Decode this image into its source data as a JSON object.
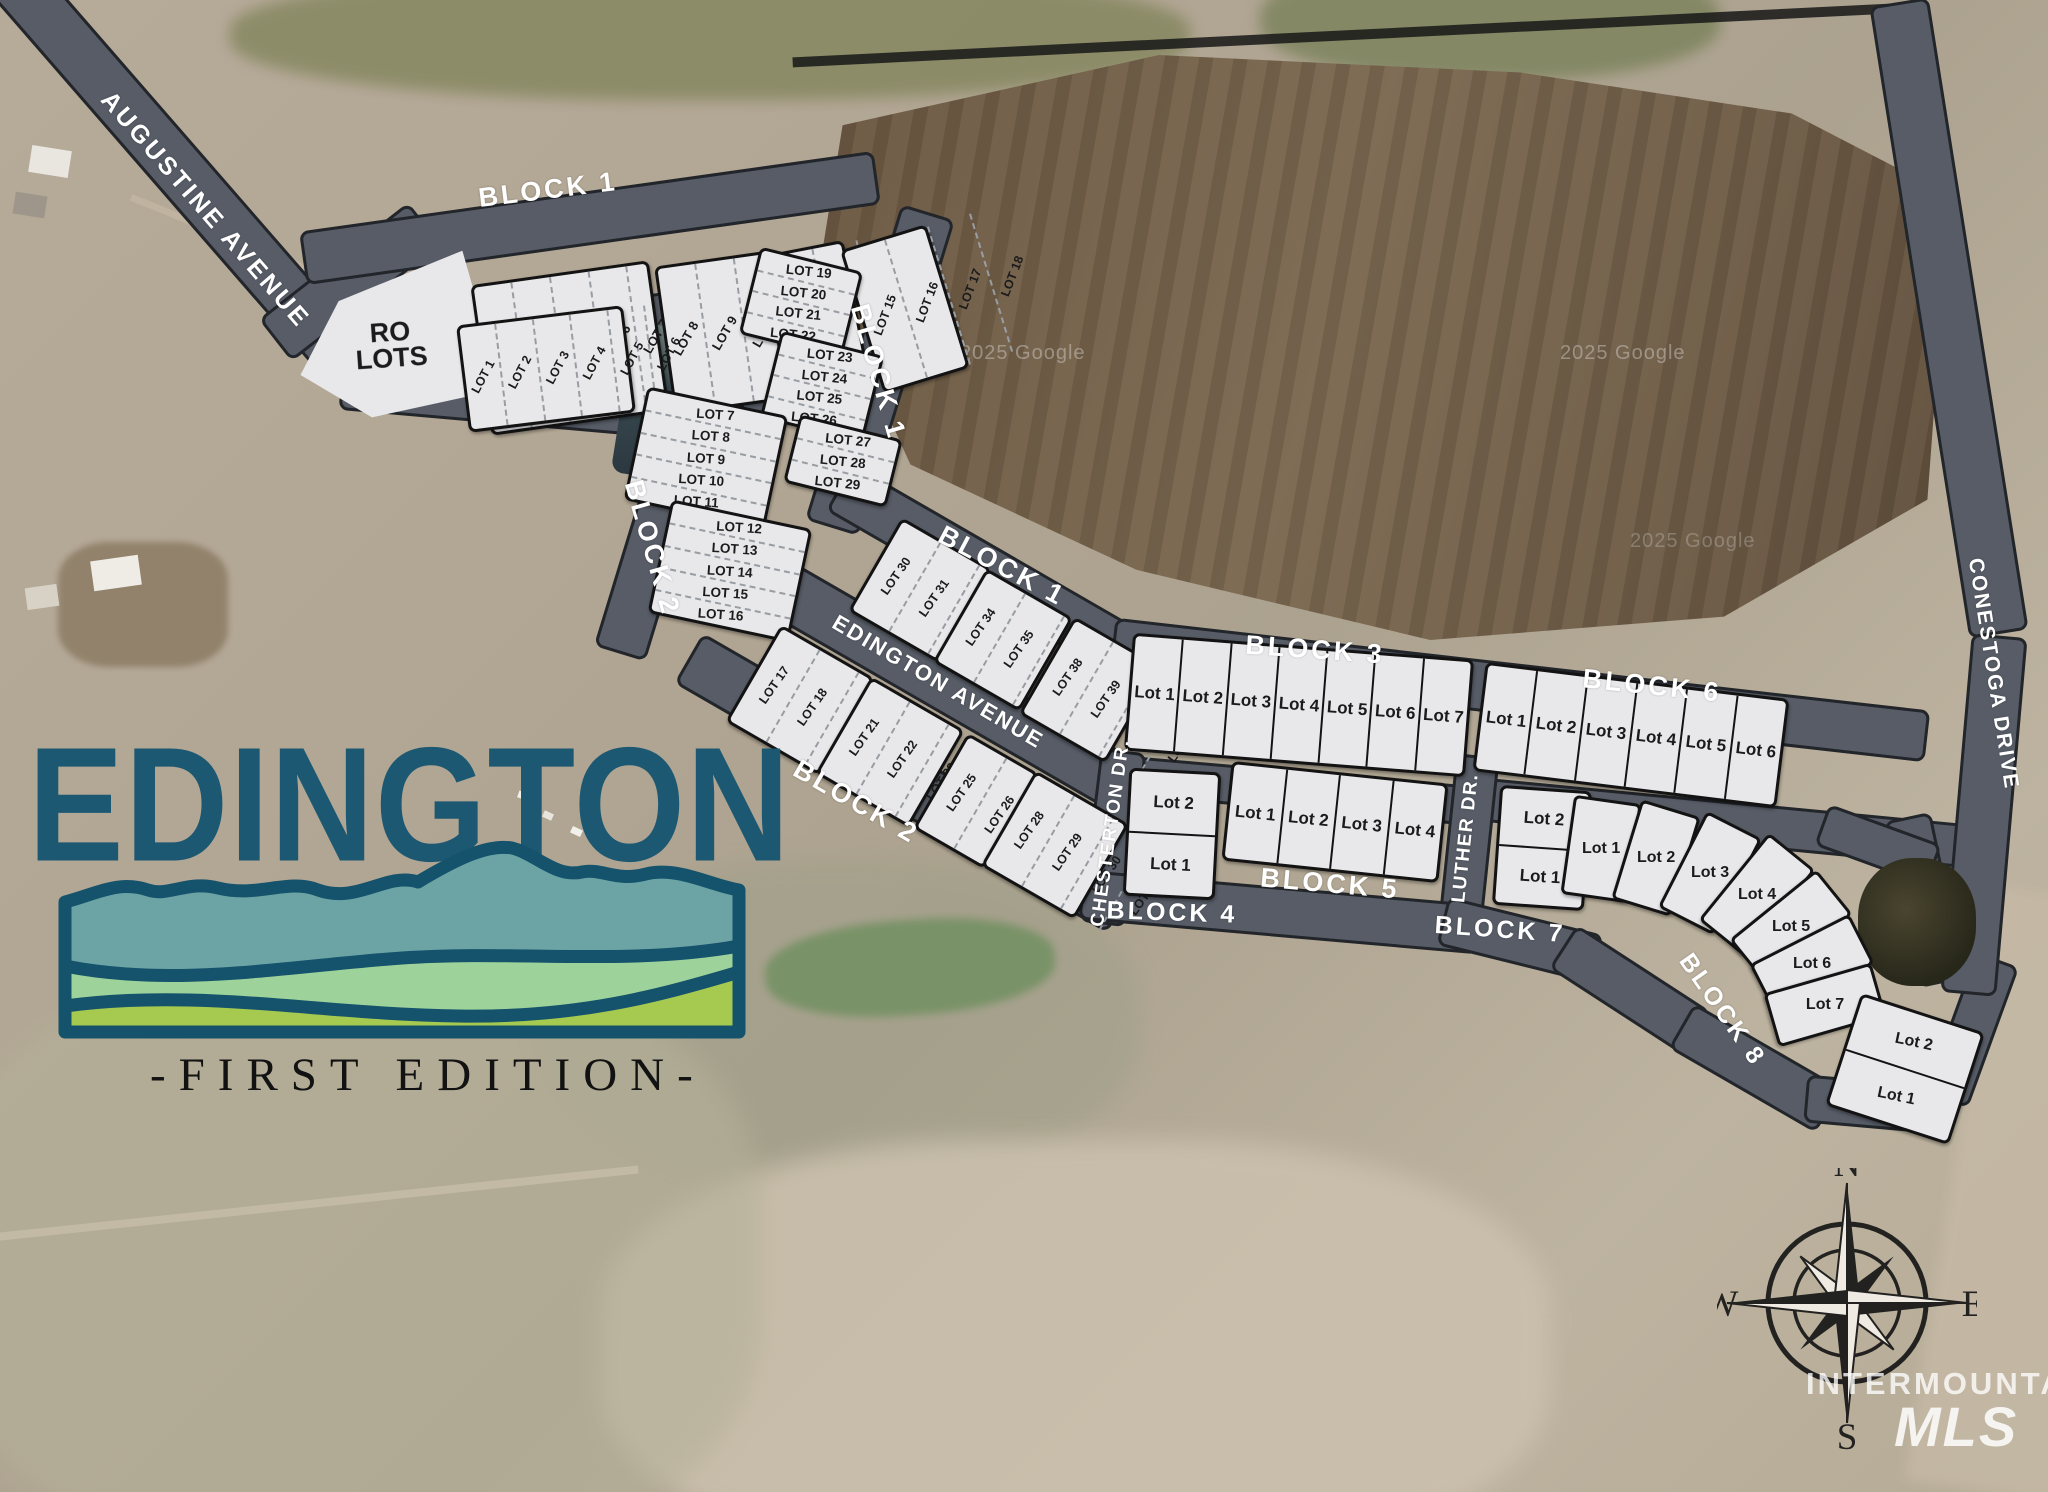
{
  "logo": {
    "name": "EDINGTON",
    "edition": "-FIRST EDITION-"
  },
  "compass": {
    "north": "N",
    "east": "E",
    "south": "S",
    "west": "W"
  },
  "watermarks": {
    "imagery": "2025 Google",
    "mls_top": "INTERMOUNTAIN",
    "mls_bottom": "MLS"
  },
  "colors": {
    "road": "#575c66",
    "lot_fill": "#e8e8ea",
    "logo_teal": "#1c5871",
    "mountain_teal": "#6ca4a5",
    "band_green": "#9ed29b",
    "band_yellow_green": "#a6c94f",
    "outline_teal": "#15526b"
  },
  "road_labels": [
    {
      "id": "augustine",
      "text": "AUGUSTINE AVENUE"
    },
    {
      "id": "block1-top",
      "text": "BLOCK 1"
    },
    {
      "id": "block1-east",
      "text": "BLOCK 1"
    },
    {
      "id": "block1-mid",
      "text": "BLOCK 1"
    },
    {
      "id": "block2-west",
      "text": "BLOCK 2"
    },
    {
      "id": "block2-south",
      "text": "BLOCK 2"
    },
    {
      "id": "edington-ave",
      "text": "EDINGTON AVENUE"
    },
    {
      "id": "block3",
      "text": "BLOCK 3"
    },
    {
      "id": "block6",
      "text": "BLOCK 6"
    },
    {
      "id": "chesterton",
      "text": "CHESTERTON DR."
    },
    {
      "id": "block4",
      "text": "BLOCK 4"
    },
    {
      "id": "block5",
      "text": "BLOCK 5"
    },
    {
      "id": "luther",
      "text": "LUTHER DR."
    },
    {
      "id": "block7",
      "text": "BLOCK 7"
    },
    {
      "id": "block8",
      "text": "BLOCK 8"
    },
    {
      "id": "conestoga",
      "text": "CONESTOGA DRIVE"
    }
  ],
  "lot_groups": [
    {
      "id": "ro-lots",
      "lots": [
        "RO LOTS"
      ]
    },
    {
      "id": "b1-top-a",
      "lots": [
        "LOT 3",
        "LOT 4",
        "LOT 5",
        "LOT 6",
        "LOT 7"
      ]
    },
    {
      "id": "b1-top-b",
      "lots": [
        "LOT 8",
        "LOT 9",
        "LOT 10",
        "LOT 11"
      ]
    },
    {
      "id": "b1-top-c",
      "lots": [
        "LOT 12",
        "LOT 13",
        "LOT 14"
      ]
    },
    {
      "id": "b1-top-d",
      "lots": [
        "LOT 15",
        "LOT 16",
        "LOT 17",
        "LOT 18"
      ]
    },
    {
      "id": "b1-east-a",
      "lots": [
        "LOT 19",
        "LOT 20",
        "LOT 21",
        "LOT 22"
      ]
    },
    {
      "id": "b1-east-b",
      "lots": [
        "LOT 23",
        "LOT 24",
        "LOT 25",
        "LOT 26"
      ]
    },
    {
      "id": "b1-east-c",
      "lots": [
        "LOT 27",
        "LOT 28",
        "LOT 29"
      ]
    },
    {
      "id": "small-block",
      "lots": [
        "LOT 1",
        "LOT 2",
        "LOT 3",
        "LOT 4",
        "LOT 5",
        "LOT 6"
      ]
    },
    {
      "id": "b2-col-a",
      "lots": [
        "LOT 7",
        "LOT 8",
        "LOT 9",
        "LOT 10",
        "LOT 11"
      ]
    },
    {
      "id": "b2-col-b",
      "lots": [
        "LOT 12",
        "LOT 13",
        "LOT 14",
        "LOT 15",
        "LOT 16"
      ]
    },
    {
      "id": "b1-mid-a",
      "lots": [
        "LOT 30",
        "LOT 31",
        "LOT 32",
        "LOT 33"
      ]
    },
    {
      "id": "b1-mid-b",
      "lots": [
        "LOT 34",
        "LOT 35",
        "LOT 36",
        "LOT 37"
      ]
    },
    {
      "id": "b1-mid-c",
      "lots": [
        "LOT 38",
        "LOT 39",
        "LOT 40",
        "LOT 41"
      ]
    },
    {
      "id": "b2-row-a",
      "lots": [
        "LOT 17",
        "LOT 18",
        "LOT 19",
        "LOT 20"
      ]
    },
    {
      "id": "b2-row-b",
      "lots": [
        "LOT 21",
        "LOT 22",
        "LOT 23",
        "LOT 24"
      ]
    },
    {
      "id": "b2-row-c",
      "lots": [
        "LOT 25",
        "LOT 26",
        "LOT 27"
      ]
    },
    {
      "id": "b2-row-d",
      "lots": [
        "LOT 28",
        "LOT 29",
        "LOT 30",
        "LOT 31"
      ]
    },
    {
      "id": "block3-lots",
      "lots": [
        "Lot 1",
        "Lot 2",
        "Lot 3",
        "Lot 4",
        "Lot 5",
        "Lot 6",
        "Lot 7"
      ]
    },
    {
      "id": "block6-lots",
      "lots": [
        "Lot 1",
        "Lot 2",
        "Lot 3",
        "Lot 4",
        "Lot 5",
        "Lot 6"
      ]
    },
    {
      "id": "block4-lots",
      "lots": [
        "Lot 2",
        "Lot 1"
      ]
    },
    {
      "id": "block5-lots",
      "lots": [
        "Lot 1",
        "Lot 2",
        "Lot 3",
        "Lot 4"
      ]
    },
    {
      "id": "block7-lots",
      "lots": [
        "Lot 2",
        "Lot 1"
      ]
    },
    {
      "id": "block8-fan",
      "lots": [
        "Lot 1",
        "Lot 2",
        "Lot 3",
        "Lot 4",
        "Lot 5",
        "Lot 6",
        "Lot 7"
      ]
    },
    {
      "id": "block8-bottom",
      "lots": [
        "Lot 2",
        "Lot 1"
      ]
    }
  ]
}
